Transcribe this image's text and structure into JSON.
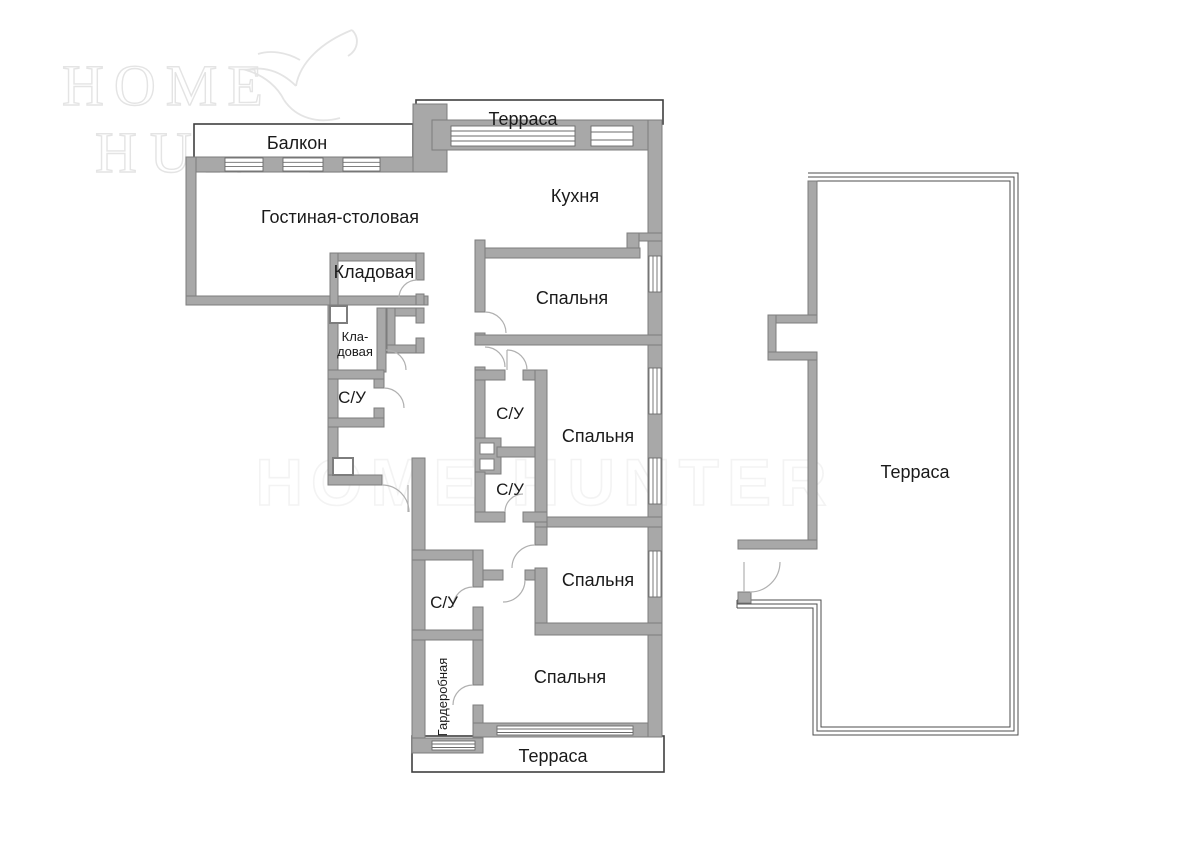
{
  "watermark": {
    "line1": "HOME",
    "line2": "HUNTER",
    "center": "HOME HUNTER"
  },
  "labels": {
    "balcony": "Балкон",
    "terrace_top": "Терраса",
    "kitchen": "Кухня",
    "living": "Гостиная-столовая",
    "storage1": "Кладовая",
    "storage2_line1": "Кла-",
    "storage2_line2": "довая",
    "bedroom1": "Спальня",
    "bedroom2": "Спальня",
    "bedroom3": "Спальня",
    "bedroom4": "Спальня",
    "wc1": "С/У",
    "wc2": "С/У",
    "wc3": "С/У",
    "wc4": "С/У",
    "wardrobe": "Гардеробная",
    "terrace_bottom": "Терраса",
    "terrace_right": "Терраса"
  },
  "rooms": [
    {
      "id": "living",
      "label": "Гостиная-столовая"
    },
    {
      "id": "kitchen",
      "label": "Кухня"
    },
    {
      "id": "balcony",
      "label": "Балкон"
    },
    {
      "id": "terrace_top",
      "label": "Терраса"
    },
    {
      "id": "terrace_bottom",
      "label": "Терраса"
    },
    {
      "id": "terrace_right",
      "label": "Терраса"
    },
    {
      "id": "bedroom1",
      "label": "Спальня"
    },
    {
      "id": "bedroom2",
      "label": "Спальня"
    },
    {
      "id": "bedroom3",
      "label": "Спальня"
    },
    {
      "id": "bedroom4",
      "label": "Спальня"
    },
    {
      "id": "wc1",
      "label": "С/У"
    },
    {
      "id": "wc2",
      "label": "С/У"
    },
    {
      "id": "wc3",
      "label": "С/У"
    },
    {
      "id": "wc4",
      "label": "С/У"
    },
    {
      "id": "storage1",
      "label": "Кладовая"
    },
    {
      "id": "storage2",
      "label": "Кла-довая"
    },
    {
      "id": "wardrobe",
      "label": "Гардеробная"
    }
  ],
  "colors": {
    "wall": "#a8a8a8",
    "wall_border": "#7d7d7d",
    "outline": "#3f3f3f",
    "arc": "#b0b0b0",
    "win": "#6b6b6b",
    "label": "#1a1a1a",
    "watermark": "#e4e4e4"
  }
}
